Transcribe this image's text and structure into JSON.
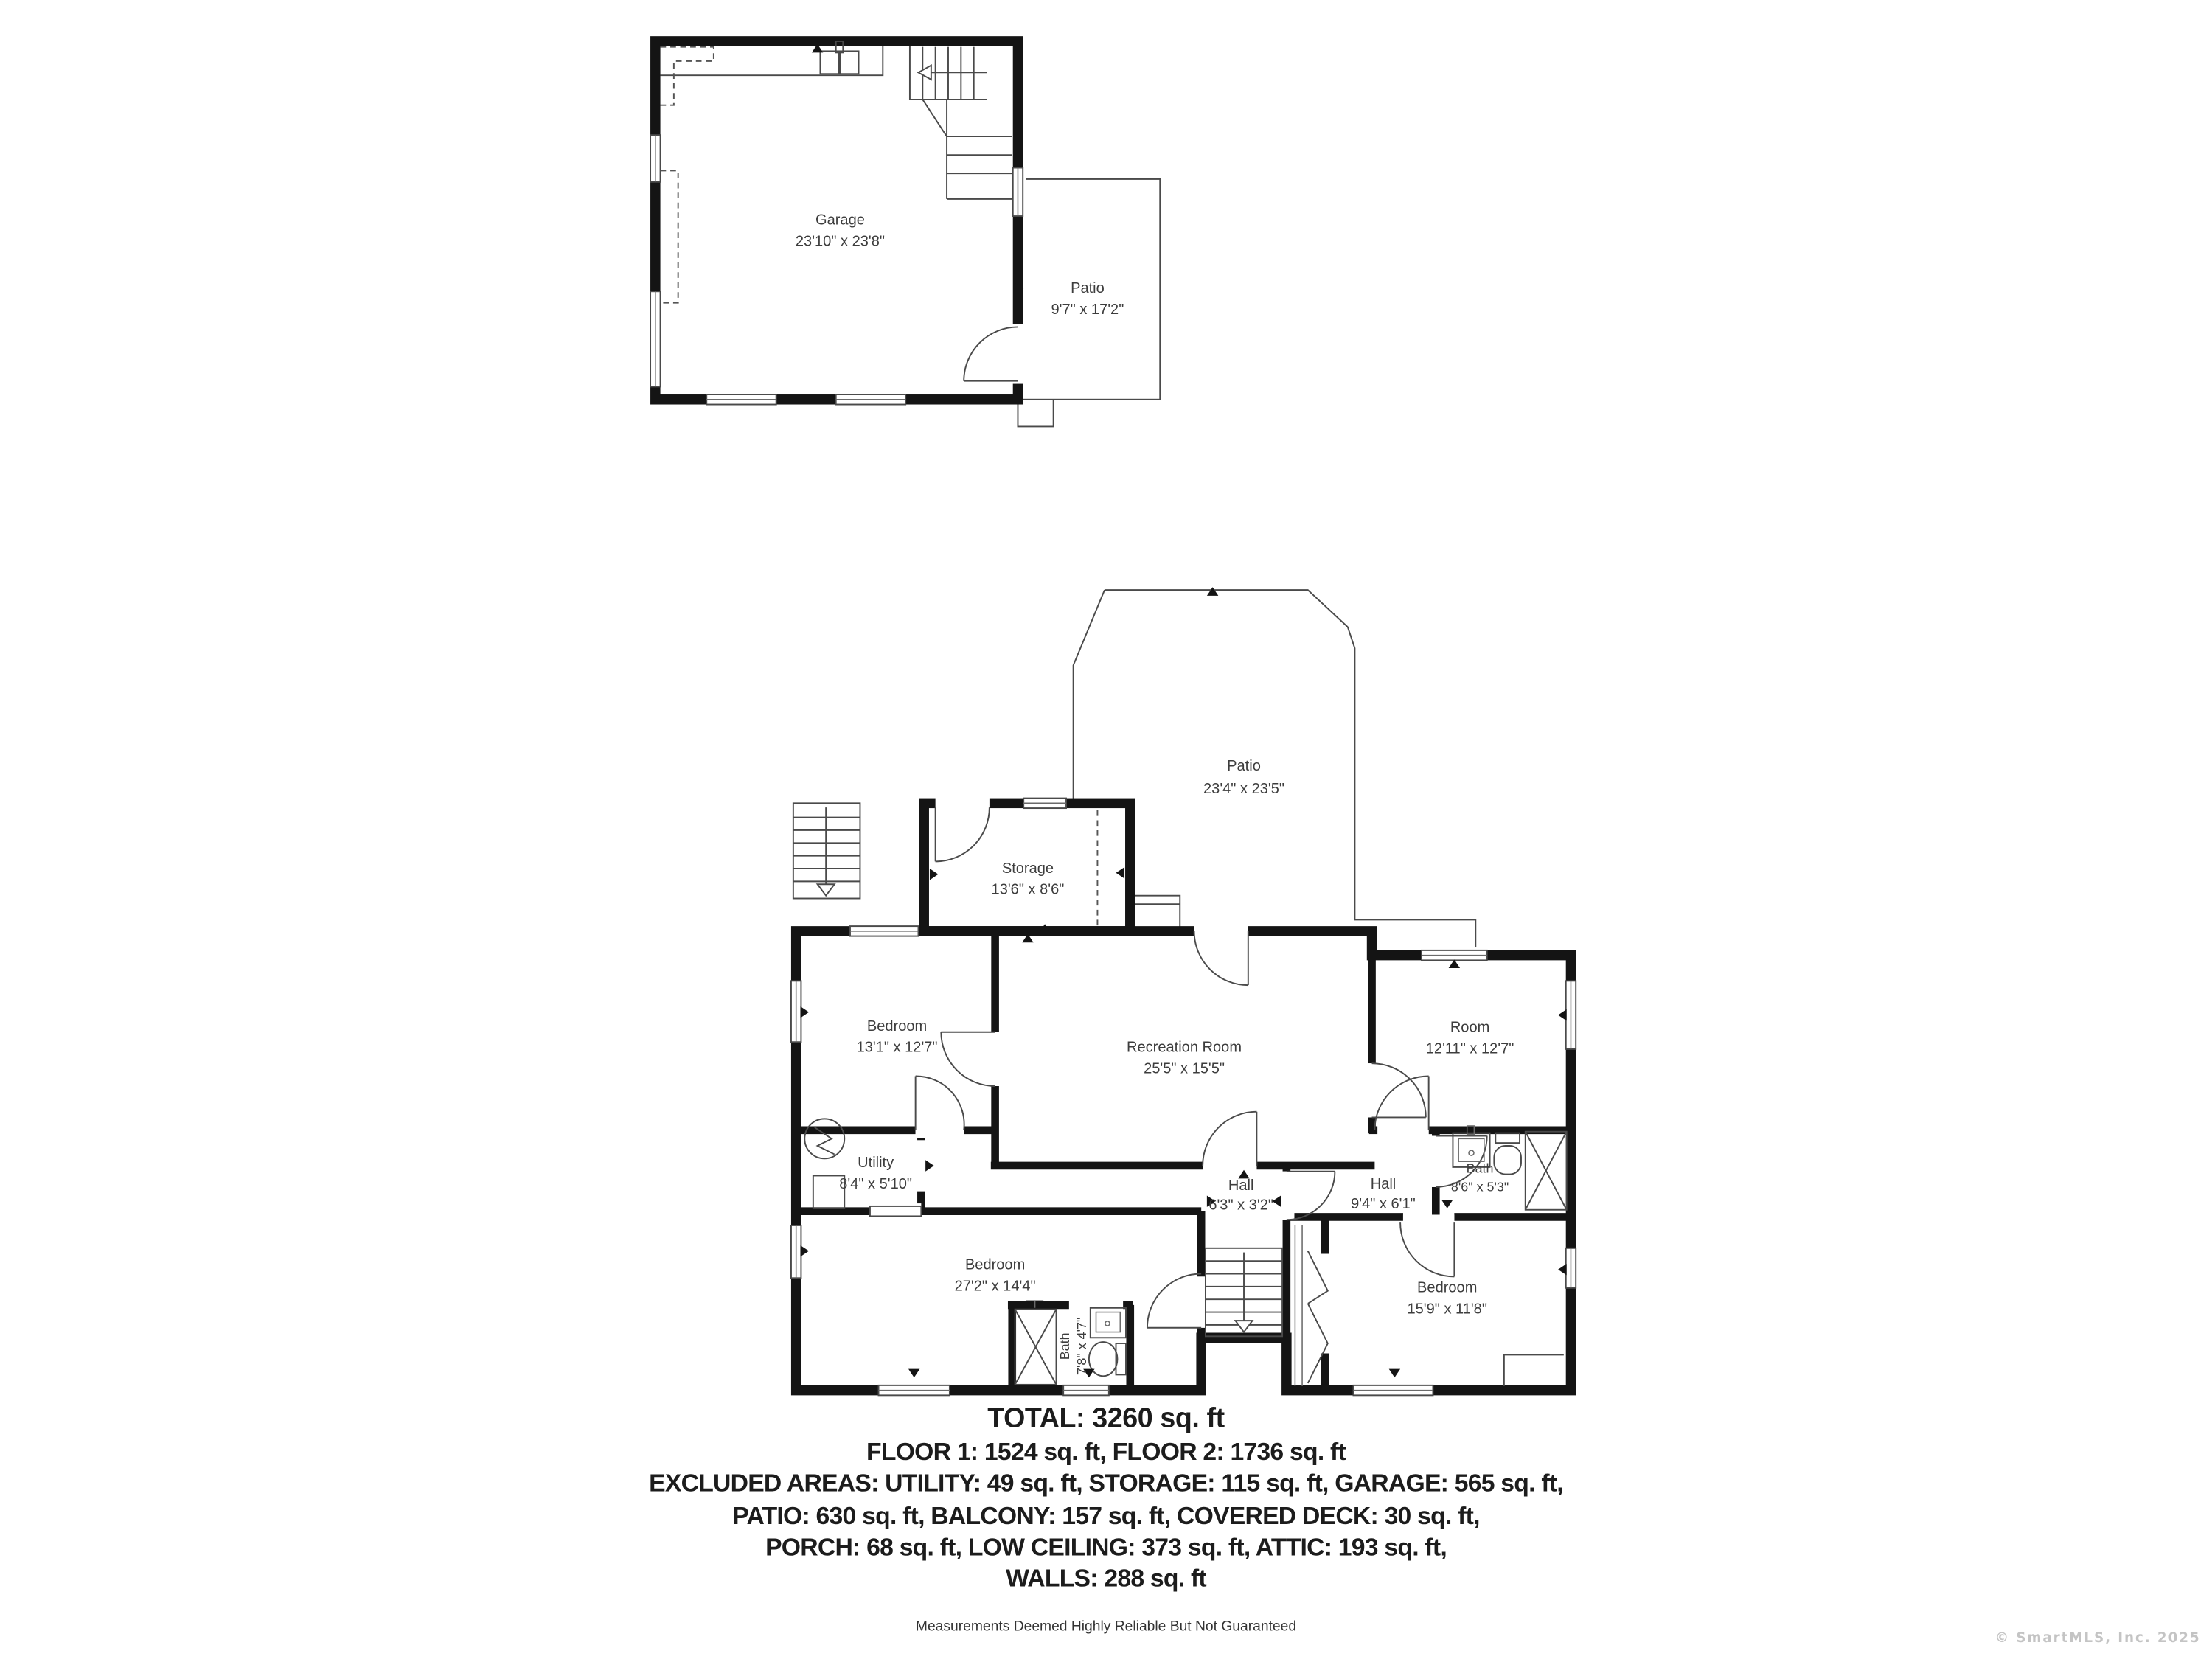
{
  "floor2": {
    "garage": {
      "name": "Garage",
      "dims": "23'10\" x 23'8\""
    },
    "patio": {
      "name": "Patio",
      "dims": "9'7\" x 17'2\""
    }
  },
  "floor1": {
    "patio": {
      "name": "Patio",
      "dims": "23'4\" x 23'5\""
    },
    "storage": {
      "name": "Storage",
      "dims": "13'6\" x 8'6\""
    },
    "bedroom_tl": {
      "name": "Bedroom",
      "dims": "13'1\" x 12'7\""
    },
    "recreation": {
      "name": "Recreation Room",
      "dims": "25'5\" x 15'5\""
    },
    "room_tr": {
      "name": "Room",
      "dims": "12'11\" x 12'7\""
    },
    "utility": {
      "name": "Utility",
      "dims": "8'4\" x 5'10\""
    },
    "hall_center": {
      "name": "Hall",
      "dims": "6'3\" x 3'2\""
    },
    "hall_right": {
      "name": "Hall",
      "dims": "9'4\" x 6'1\""
    },
    "bath_right": {
      "name": "Bath",
      "dims": "8'6\" x 5'3\""
    },
    "bedroom_bl": {
      "name": "Bedroom",
      "dims": "27'2\" x 14'4\""
    },
    "bath_bl": {
      "name": "Bath",
      "dims": "7'8\" x 4'7\""
    },
    "bedroom_br": {
      "name": "Bedroom",
      "dims": "15'9\" x 11'8\""
    }
  },
  "summary": {
    "total": "TOTAL: 3260 sq. ft",
    "line2": "FLOOR 1: 1524 sq. ft, FLOOR 2: 1736 sq. ft",
    "line3": "EXCLUDED AREAS: UTILITY: 49 sq. ft, STORAGE: 115 sq. ft, GARAGE: 565 sq. ft,",
    "line4": "PATIO: 630 sq. ft, BALCONY: 157 sq. ft, COVERED DECK: 30 sq. ft,",
    "line5": "PORCH: 68 sq. ft, LOW CEILING: 373 sq. ft, ATTIC: 193 sq. ft,",
    "line6": "WALLS: 288 sq. ft"
  },
  "disclaimer": "Measurements Deemed Highly Reliable But Not Guaranteed",
  "watermark": "© SmartMLS, Inc.  2025",
  "colors": {
    "wall": "#141414",
    "thin_line": "#4a4a4a",
    "label_text": "#3d3d3d",
    "watermark": "#c4c4c4"
  }
}
